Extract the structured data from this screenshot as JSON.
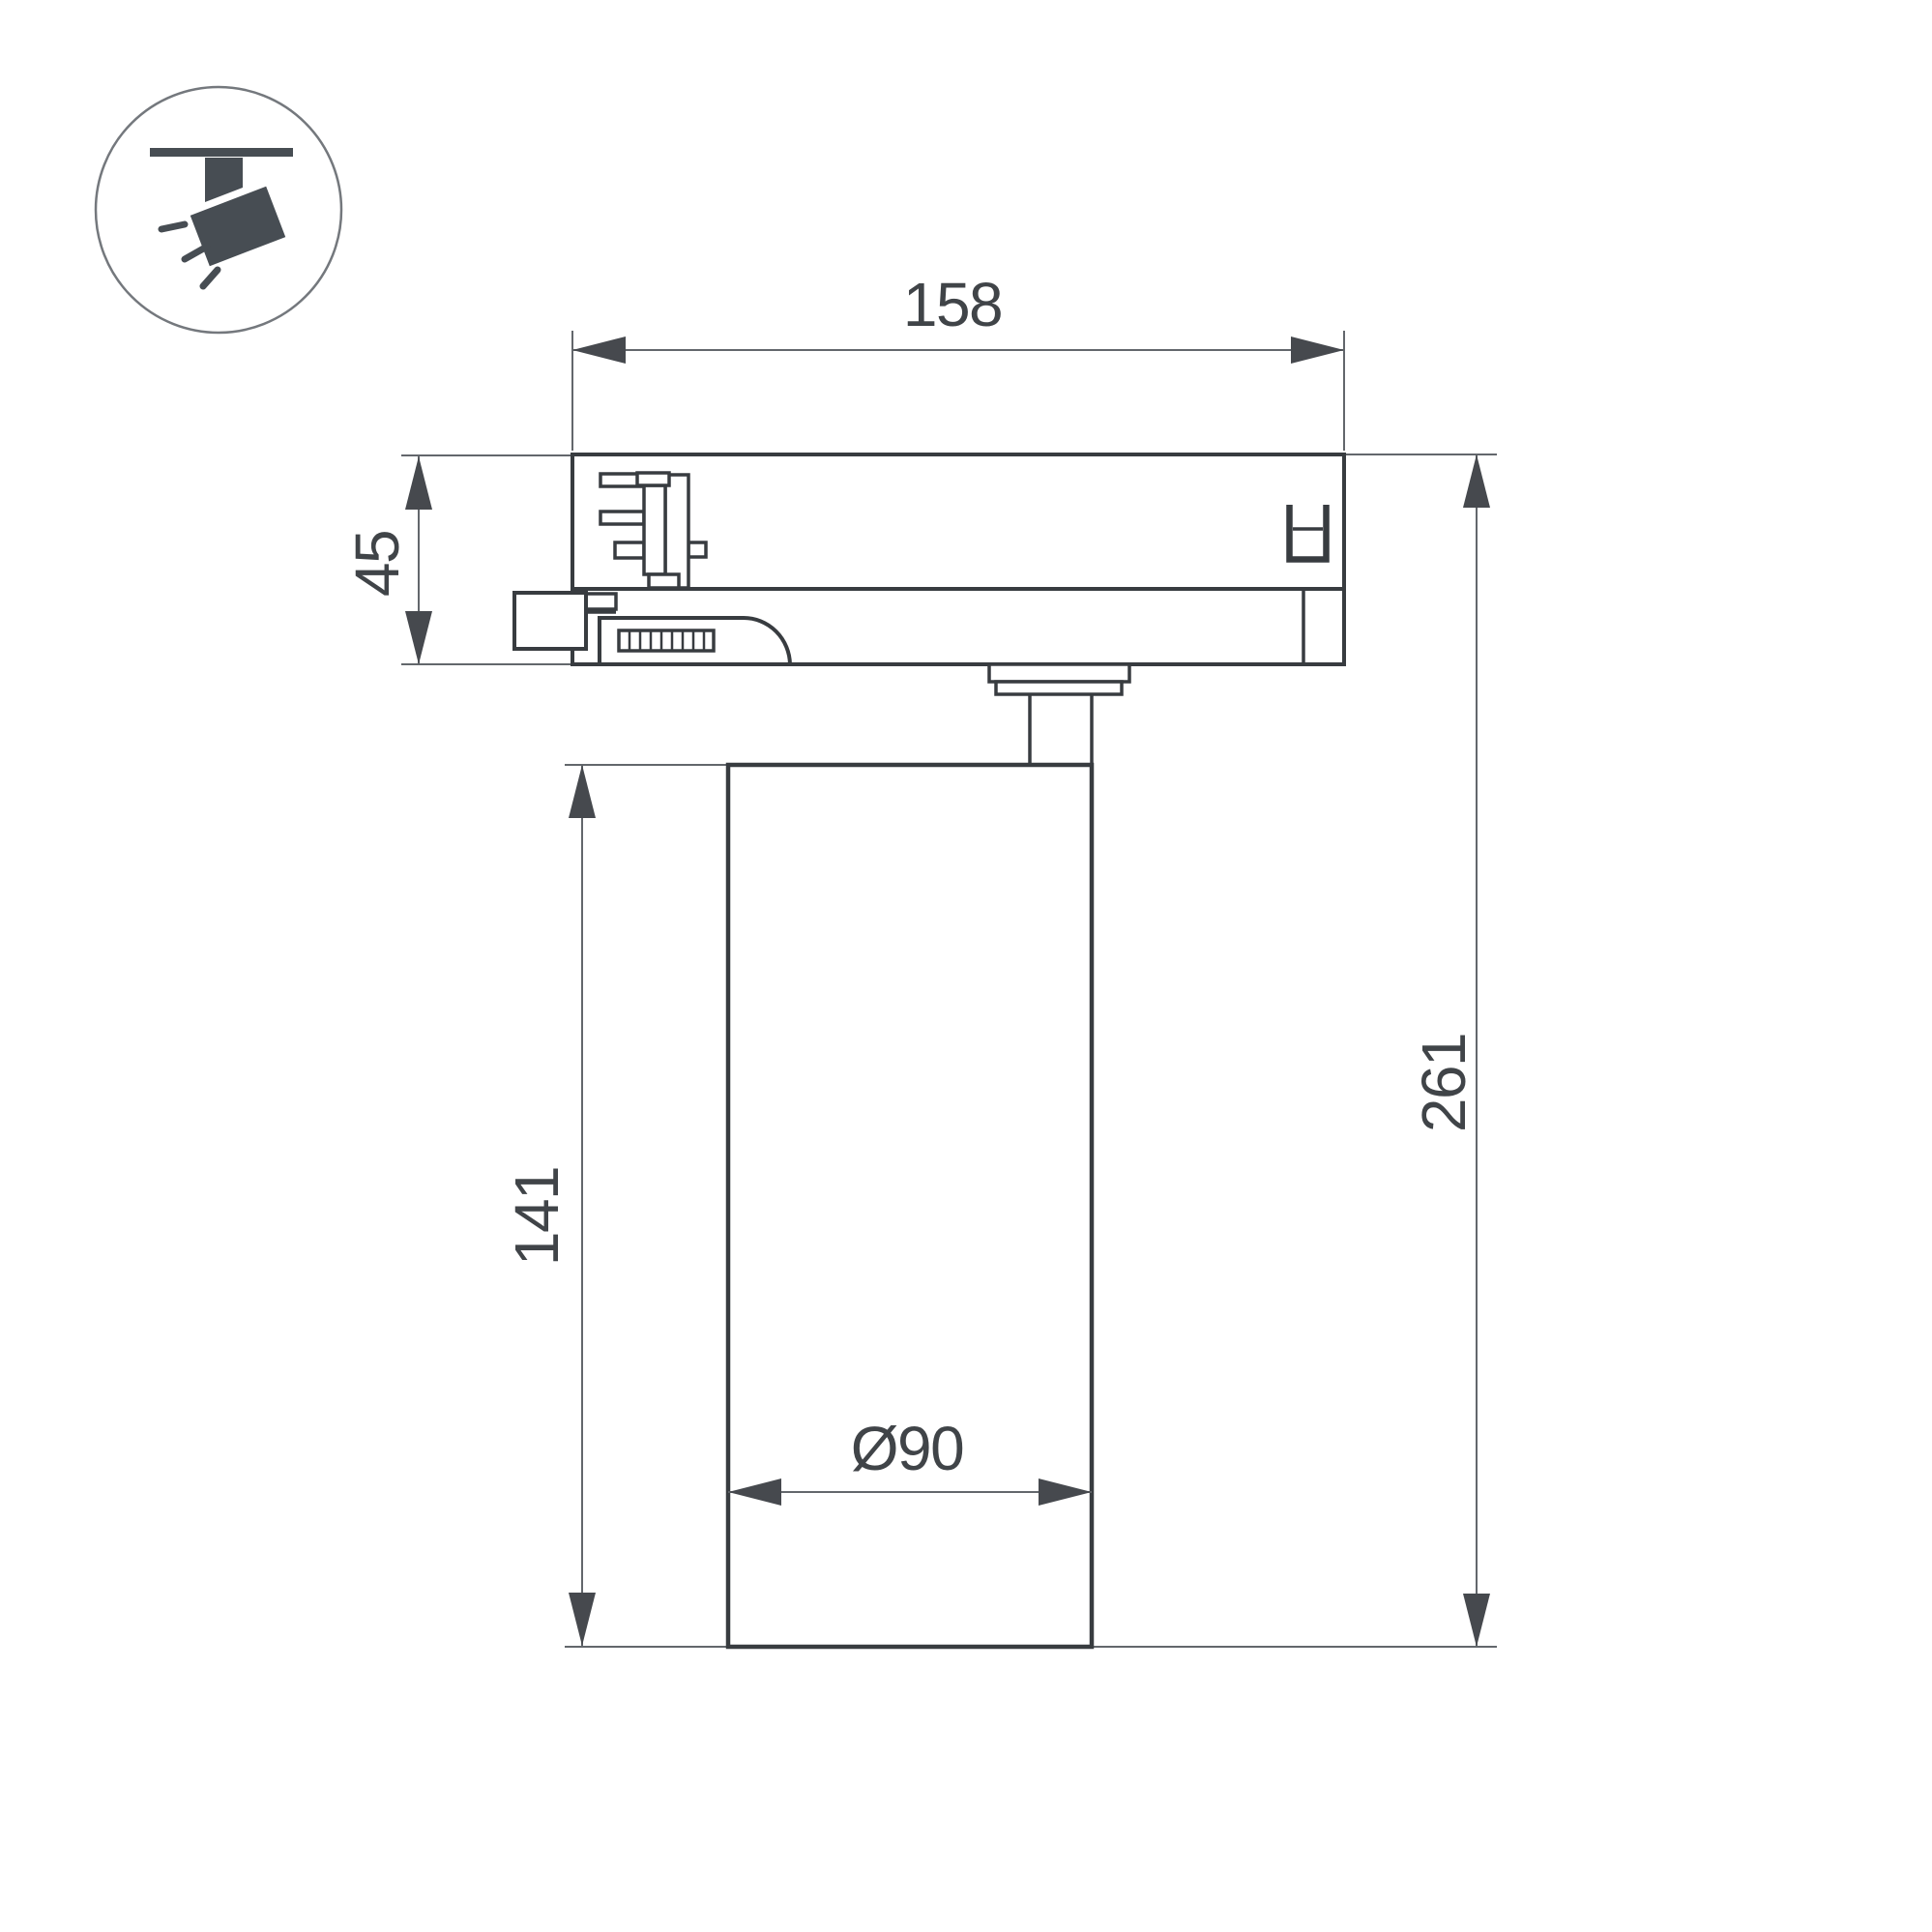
{
  "icon": {
    "label": "track-mounted-spotlight"
  },
  "dimensions": {
    "width": {
      "label": "158"
    },
    "adapter_height": {
      "label": "45"
    },
    "body_height": {
      "label": "141"
    },
    "overall_height": {
      "label": "261"
    },
    "diameter": {
      "label": "Ø90"
    }
  },
  "colors": {
    "background": "#ffffff",
    "outline": "#383c40",
    "dimension_line": "#63676c",
    "dimension_text": "#404448",
    "icon": "#474d53"
  }
}
